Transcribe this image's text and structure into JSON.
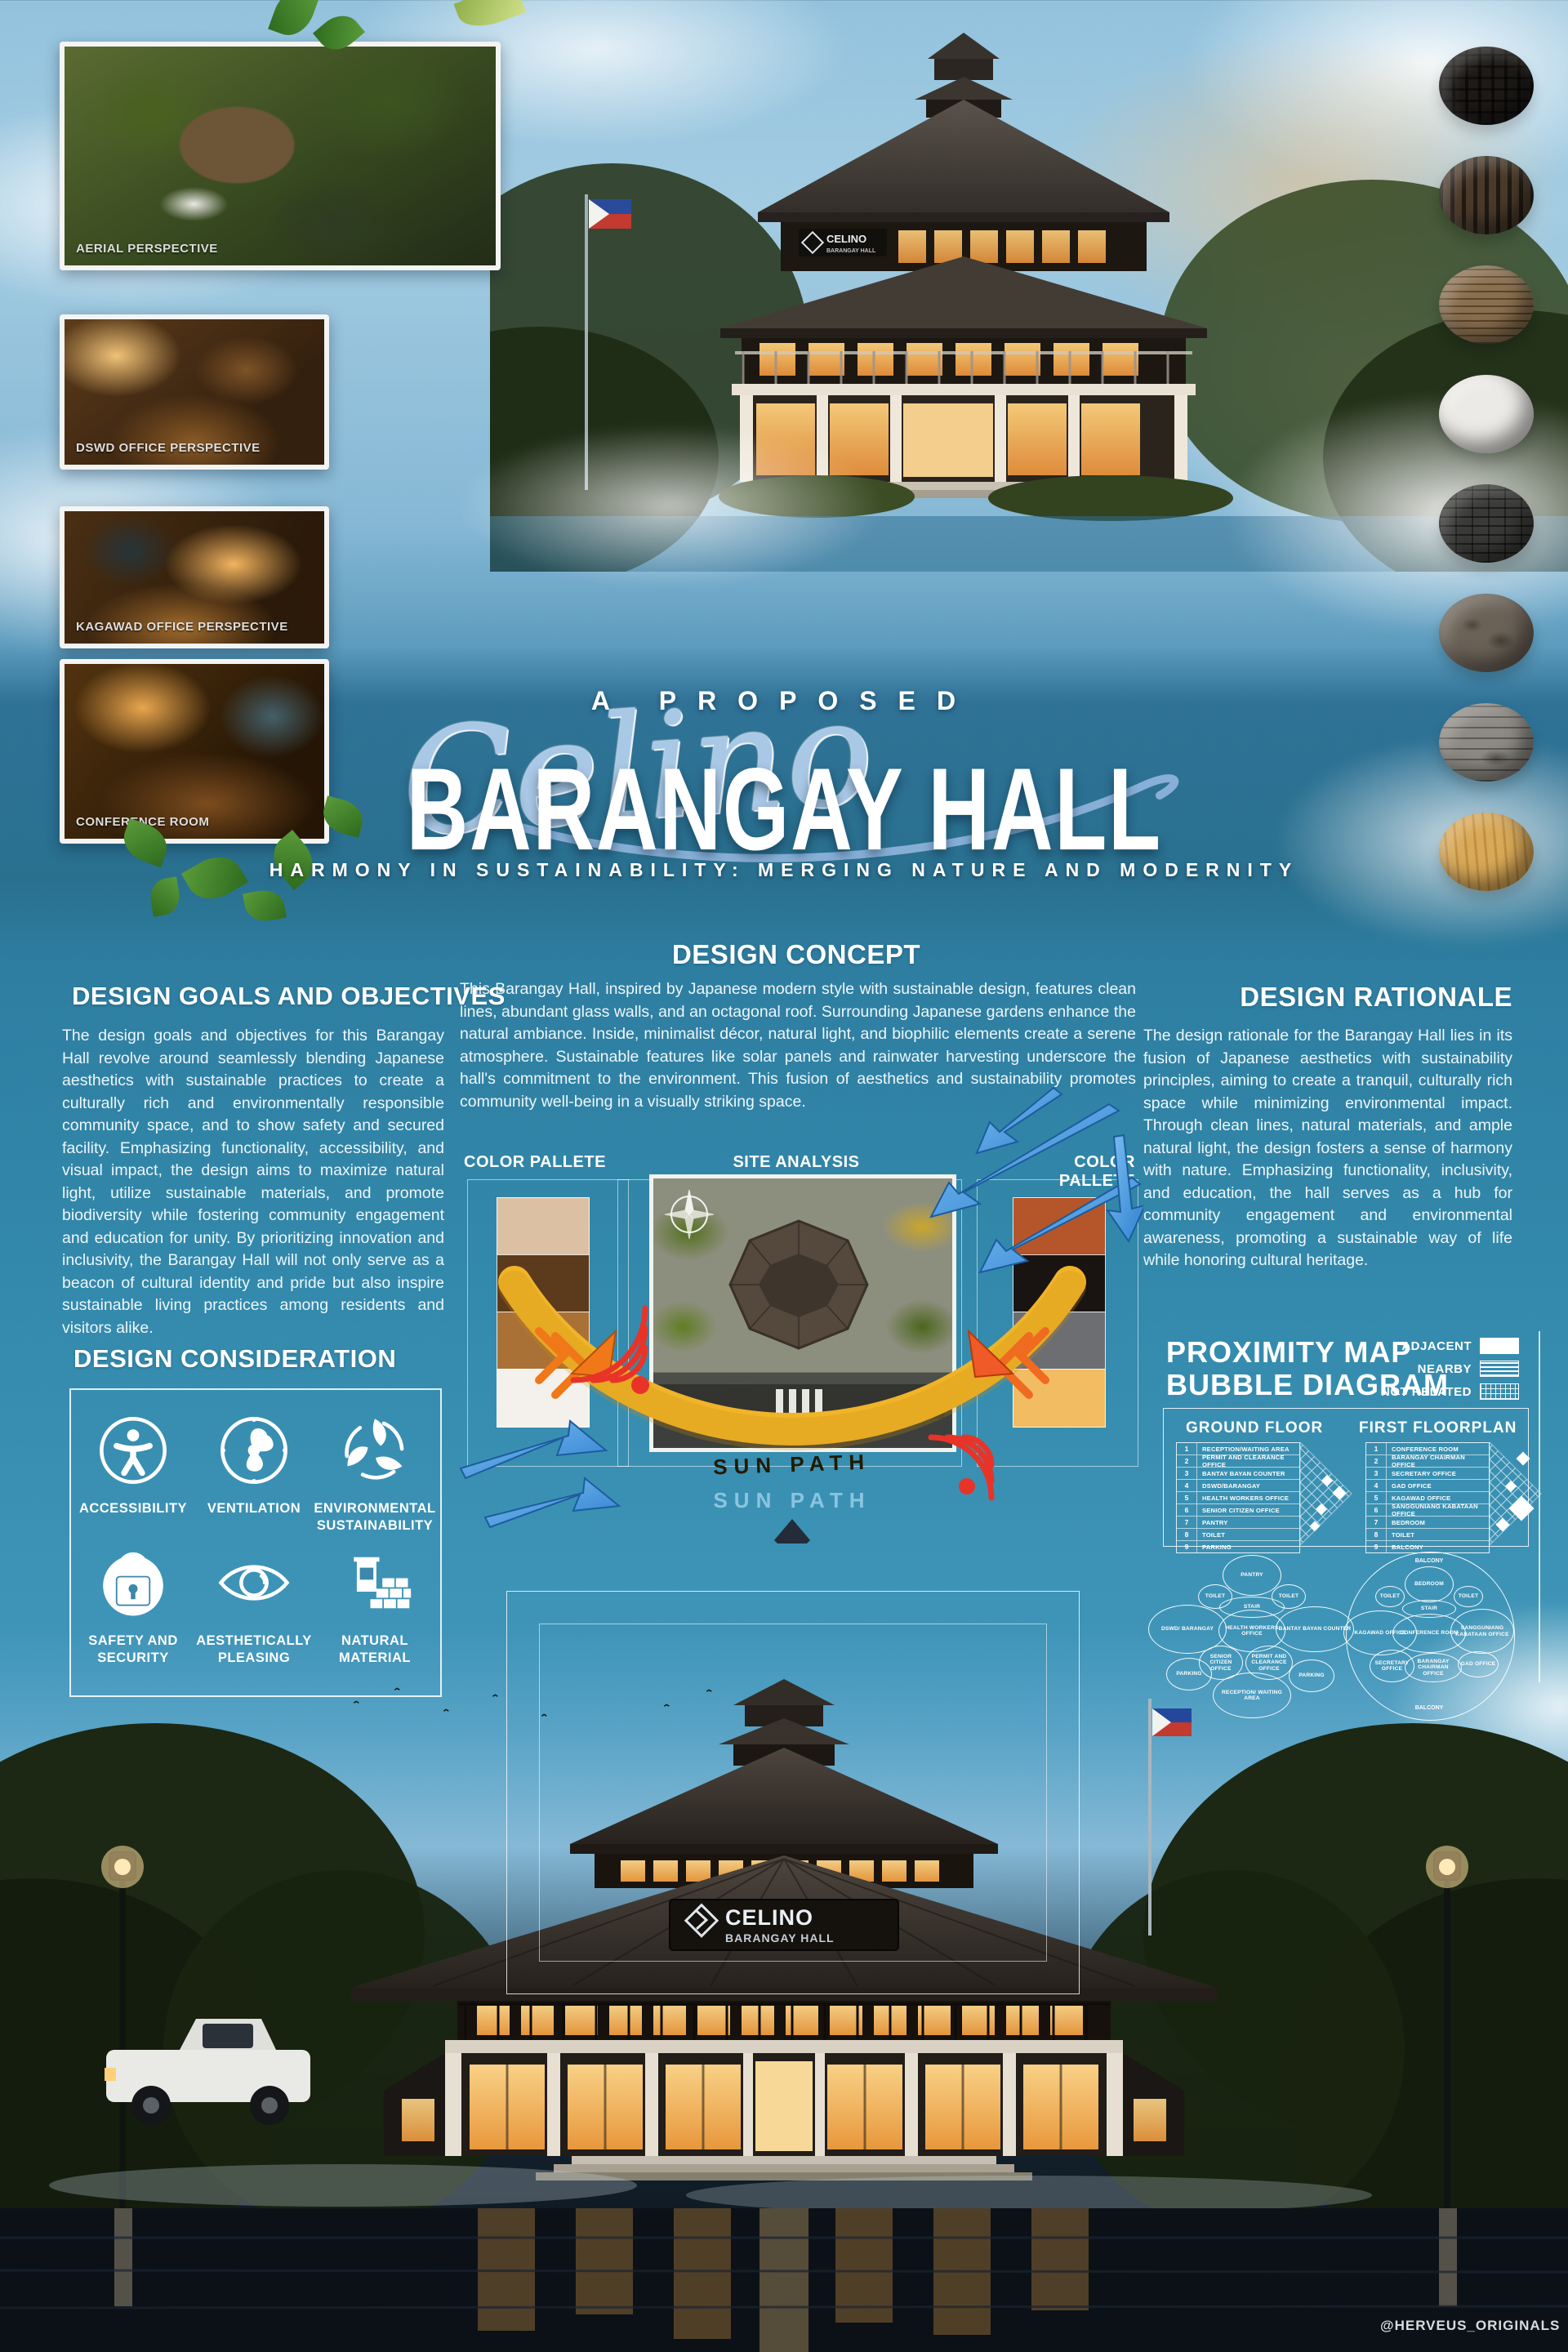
{
  "title": {
    "kicker": "A PROPOSED",
    "script_name": "Celino",
    "main": "BARANGAY HALL",
    "subtitle": "HARMONY IN SUSTAINABILITY: MERGING NATURE AND MODERNITY"
  },
  "photos": {
    "p1": "AERIAL PERSPECTIVE",
    "p2": "DSWD OFFICE PERSPECTIVE",
    "p3": "KAGAWAD OFFICE PERSPECTIVE",
    "p4": "CONFERENCE ROOM"
  },
  "goals": {
    "heading": "DESIGN GOALS AND OBJECTIVES",
    "body": "The design goals and objectives for this Barangay Hall revolve around seamlessly blending Japanese aesthetics with sustainable practices to create a culturally rich and environmentally responsible community space, and to show safety and secured facility. Emphasizing functionality, accessibility, and visual impact, the design aims to maximize natural light, utilize sustainable materials, and promote biodiversity while fostering community engagement and education for unity. By prioritizing innovation and inclusivity, the Barangay Hall will not only serve as a beacon of cultural identity and pride but also inspire sustainable living practices among residents and visitors alike."
  },
  "concept": {
    "heading": "DESIGN CONCEPT",
    "body": "This  Barangay Hall, inspired by Japanese modern style with sustainable design, features clean lines, abundant glass walls, and an octagonal roof. Surrounding Japanese gardens enhance the natural ambiance. Inside, minimalist décor, natural light, and biophilic elements create a serene atmosphere. Sustainable features like solar panels and rainwater harvesting underscore the hall's commitment to the environment. This fusion of aesthetics and sustainability promotes community well-being in a visually striking space."
  },
  "rationale": {
    "heading": "DESIGN RATIONALE",
    "body": "The design rationale for the Barangay Hall lies in its fusion of Japanese aesthetics with sustainability principles, aiming to create a tranquil, culturally rich space while minimizing environmental impact. Through clean lines, natural materials, and ample natural light, the design fosters a sense of harmony with nature. Emphasizing functionality, inclusivity, and education, the hall serves as a hub for community engagement and environmental awareness, promoting a sustainable way of life while honoring cultural heritage."
  },
  "labels": {
    "palette_left": "COLOR PALLETE",
    "site": "SITE ANALYSIS",
    "palette_right": "COLOR PALLETE",
    "sun_path": "SUN PATH",
    "sun_path_ghost": "SUN PATH"
  },
  "palette_left_colors": [
    "#dcc0a3",
    "#5c3a1c",
    "#aa7136",
    "#f4f1ec"
  ],
  "palette_right_colors": [
    "#b4552a",
    "#191311",
    "#6c6e72",
    "#f2bc63"
  ],
  "material_sphere_colors": [
    "#1d1a17",
    "#4a3a2a",
    "#8a6f4e",
    "#eceae6",
    "#3a3a38",
    "#6b6257",
    "#8d8a84",
    "#d8a957"
  ],
  "consideration": {
    "heading": "DESIGN CONSIDERATION",
    "items": [
      {
        "icon": "accessibility-icon",
        "label": "ACCESSIBILITY"
      },
      {
        "icon": "fan-icon",
        "label": "VENTILATION"
      },
      {
        "icon": "recycle-leaves-icon",
        "label": "ENVIRONMENTAL SUSTAINABILITY"
      },
      {
        "icon": "lock-icon",
        "label": "SAFETY AND SECURITY"
      },
      {
        "icon": "eye-icon",
        "label": "AESTHETICALLY PLEASING"
      },
      {
        "icon": "bricks-icon",
        "label": "NATURAL MATERIAL"
      }
    ]
  },
  "proximity": {
    "heading1": "PROXIMITY MAP",
    "heading2": "BUBBLE DIAGRAM",
    "legend": [
      {
        "label": "ADJACENT",
        "style": "solid"
      },
      {
        "label": "NEARBY",
        "style": "striped"
      },
      {
        "label": "NOT RELATED",
        "style": "dotted"
      }
    ],
    "nums": [
      "1",
      "2",
      "3",
      "4",
      "5",
      "6",
      "7",
      "8",
      "9"
    ],
    "ground": {
      "title": "GROUND FLOOR",
      "rooms": [
        "RECEPTION/WAITING AREA",
        "PERMIT AND CLEARANCE OFFICE",
        "BANTAY BAYAN COUNTER",
        "DSWD/BARANGAY",
        "HEALTH WORKERS OFFICE",
        "SENIOR CITIZEN OFFICE",
        "PANTRY",
        "TOILET",
        "PARKING"
      ]
    },
    "first": {
      "title": "FIRST FLOORPLAN",
      "rooms": [
        "CONFERENCE ROOM",
        "BARANGAY CHAIRMAN OFFICE",
        "SECRETARY OFFICE",
        "GAD OFFICE",
        "KAGAWAD OFFICE",
        "SANGGUNIANG KABATAAN OFFICE",
        "BEDROOM",
        "TOILET",
        "BALCONY"
      ]
    },
    "bubbles_ground": [
      "PANTRY",
      "TOILET",
      "TOILET",
      "STAIR",
      "DSWD/ BARANGAY",
      "HEALTH WORKERS OFFICE",
      "BANTAY BAYAN COUNTER",
      "SENIOR CITIZEN OFFICE",
      "PERMIT AND CLEARANCE OFFICE",
      "PARKING",
      "PARKING",
      "RECEPTION/ WAITING AREA"
    ],
    "bubbles_first": [
      "BALCONY",
      "BEDROOM",
      "TOILET",
      "TOILET",
      "STAIR",
      "KAGAWAD OFFICE",
      "CONFERENCE ROOM",
      "SANGGUNIANG KABATAAN OFFICE",
      "SECRETARY OFFICE",
      "BARANGAY CHAIRMAN OFFICE",
      "GAD OFFICE",
      "BALCONY"
    ]
  },
  "building_sign": {
    "name": "CELINO",
    "sub": "BARANGAY HALL"
  },
  "credit": "@HERVEUS_ORIGINALS"
}
